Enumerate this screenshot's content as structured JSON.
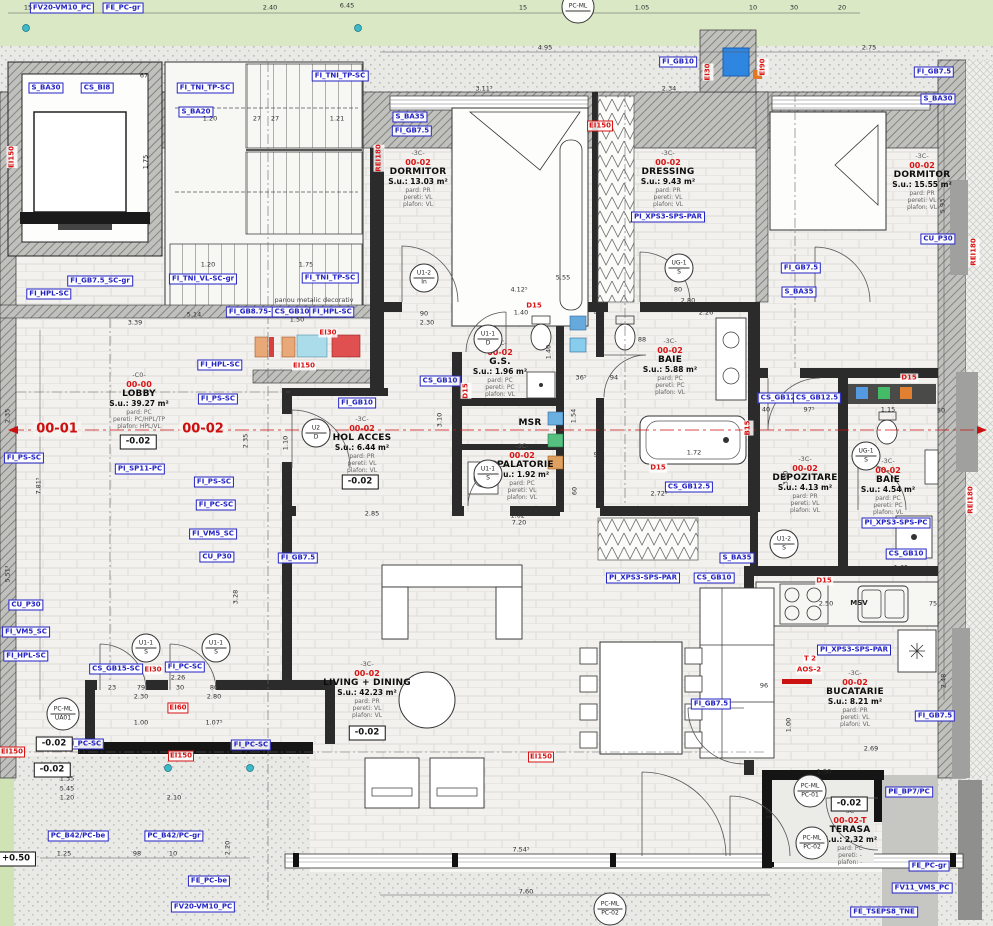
{
  "colors": {
    "label_blue": "#2323c4",
    "annotation_red": "#d81414",
    "wall_dark": "#2b2b2b",
    "hatch_gray": "#9a9a98",
    "floor": "#f1f0ed",
    "green_exterior": "#dbe8c6",
    "terrace_gray": "#c6c6c3",
    "fixture_blue": "#2e86e0"
  },
  "rooms": [
    {
      "grade": "-C0-",
      "code": "00-00",
      "name": "LOBBY",
      "area": "S.u.: 39.27 m²",
      "pard": "pard: PC",
      "pereti": "pereti: PC/HPL/TP",
      "plafon": "plafon: HPL/VL",
      "x": 139,
      "y": 372
    },
    {
      "grade": "-3C-",
      "code": "00-02",
      "name": "DORMITOR",
      "area": "S.u.: 13.03 m²",
      "pard": "pard: PR",
      "pereti": "pereti: VL",
      "plafon": "plafon: VL",
      "x": 418,
      "y": 150
    },
    {
      "grade": "-3C-",
      "code": "00-02",
      "name": "DRESSING",
      "area": "S.u.: 9.43 m²",
      "pard": "pard: PR",
      "pereti": "pereti: VL",
      "plafon": "plafon: VL",
      "x": 668,
      "y": 150
    },
    {
      "grade": "-3C-",
      "code": "00-02",
      "name": "DORMITOR",
      "area": "S.u.: 15.55 m²",
      "pard": "pard: PR",
      "pereti": "pereti: VL",
      "plafon": "plafon: VL",
      "x": 922,
      "y": 153
    },
    {
      "grade": "-3C-",
      "code": "00-02",
      "name": "G.S.",
      "area": "S.u.: 1.96 m²",
      "pard": "pard: PC",
      "pereti": "pereti: PC",
      "plafon": "plafon: VL",
      "x": 500,
      "y": 340
    },
    {
      "grade": "-3C-",
      "code": "00-02",
      "name": "BAIE",
      "area": "S.u.: 5.88 m²",
      "pard": "pard: PC",
      "pereti": "pereti: PC",
      "plafon": "plafon: VL",
      "x": 670,
      "y": 338
    },
    {
      "grade": "",
      "code": "",
      "name": "MSR",
      "area": "",
      "pard": "",
      "pereti": "",
      "plafon": "",
      "x": 530,
      "y": 418
    },
    {
      "grade": "-3C-",
      "code": "00-02",
      "name": "SPALATORIE",
      "area": "S.u.: 1.92 m²",
      "pard": "pard: PC",
      "pereti": "pereti: VL",
      "plafon": "plafon: VL",
      "x": 522,
      "y": 443
    },
    {
      "grade": "-3C-",
      "code": "00-02",
      "name": "HOL ACCES",
      "area": "S.u.: 6.44 m²",
      "pard": "pard: PR",
      "pereti": "pereti: VL",
      "plafon": "plafon: VL",
      "x": 362,
      "y": 416
    },
    {
      "grade": "-3C-",
      "code": "00-02",
      "name": "DEPOZITARE",
      "area": "S.u.: 4.13 m²",
      "pard": "pard: PR",
      "pereti": "pereti: VL",
      "plafon": "plafon: VL",
      "x": 805,
      "y": 456
    },
    {
      "grade": "-3C-",
      "code": "00-02",
      "name": "BAIE",
      "area": "S.u.: 4.54 m²",
      "pard": "pard: PC",
      "pereti": "pereti: PC",
      "plafon": "plafon: VL",
      "x": 888,
      "y": 458
    },
    {
      "grade": "-3C-",
      "code": "00-02",
      "name": "LIVING + DINING",
      "area": "S.u.: 42.23 m²",
      "pard": "pard: PR",
      "pereti": "pereti: VL",
      "plafon": "plafon: VL",
      "x": 367,
      "y": 661
    },
    {
      "grade": "-3C-",
      "code": "00-02",
      "name": "BUCATARIE",
      "area": "S.u.: 8.21 m²",
      "pard": "pard: PR",
      "pereti": "pereti: VL",
      "plafon": "plafon: VL",
      "x": 855,
      "y": 670
    },
    {
      "grade": "-3C-",
      "code": "00-02-T",
      "name": "TERASA",
      "area": "S.u.: 2.32 m²",
      "pard": "pard: PC",
      "pereti": "pereti: -",
      "plafon": "plafon: -",
      "x": 850,
      "y": 808
    }
  ],
  "axis_labels": [
    {
      "t": "00-01",
      "x": 57,
      "y": 429
    },
    {
      "t": "00-02",
      "x": 203,
      "y": 429
    }
  ],
  "blue_labels": [
    {
      "t": "FV20-VM10_PC",
      "x": 62,
      "y": 8
    },
    {
      "t": "FE_PC-gr",
      "x": 123,
      "y": 8
    },
    {
      "t": "S_BA30",
      "x": 46,
      "y": 88
    },
    {
      "t": "CS_BI8",
      "x": 97,
      "y": 88
    },
    {
      "t": "FI_TNI_TP-SC",
      "x": 205,
      "y": 88
    },
    {
      "t": "S_BA20",
      "x": 196,
      "y": 112
    },
    {
      "t": "FI_TNI_TP-SC",
      "x": 340,
      "y": 76
    },
    {
      "t": "FI_GB10",
      "x": 678,
      "y": 62
    },
    {
      "t": "FI_GB7.5",
      "x": 934,
      "y": 72
    },
    {
      "t": "S_BA30",
      "x": 938,
      "y": 99
    },
    {
      "t": "S_BA35",
      "x": 410,
      "y": 117
    },
    {
      "t": "FI_GB7.5",
      "x": 412,
      "y": 131
    },
    {
      "t": "PI_XPS3-SPS-PAR",
      "x": 668,
      "y": 217
    },
    {
      "t": "CU_P30",
      "x": 938,
      "y": 239
    },
    {
      "t": "FI_GB7.5_SC-gr",
      "x": 100,
      "y": 281
    },
    {
      "t": "FI_TNI_VL-SC-gr",
      "x": 203,
      "y": 279
    },
    {
      "t": "FI_TNI_TP-SC",
      "x": 330,
      "y": 278
    },
    {
      "t": "FI_HPL-SC",
      "x": 49,
      "y": 294
    },
    {
      "t": "FI_GB8.75-SC",
      "x": 255,
      "y": 312
    },
    {
      "t": "CS_GB10",
      "x": 292,
      "y": 312
    },
    {
      "t": "FI_HPL-SC",
      "x": 332,
      "y": 312
    },
    {
      "t": "FI_HPL-SC",
      "x": 220,
      "y": 365
    },
    {
      "t": "FI_GB7.5",
      "x": 801,
      "y": 268
    },
    {
      "t": "S_BA35",
      "x": 799,
      "y": 292
    },
    {
      "t": "FI_PS-SC",
      "x": 218,
      "y": 399
    },
    {
      "t": "FI_PS-SC",
      "x": 24,
      "y": 458
    },
    {
      "t": "PI_SP11-PC",
      "x": 140,
      "y": 469
    },
    {
      "t": "FI_PS-SC",
      "x": 214,
      "y": 482
    },
    {
      "t": "FI_PC-SC",
      "x": 216,
      "y": 505
    },
    {
      "t": "FI_VM5_SC",
      "x": 213,
      "y": 534
    },
    {
      "t": "CU_P30",
      "x": 217,
      "y": 557
    },
    {
      "t": "FI_GB7.5",
      "x": 298,
      "y": 558
    },
    {
      "t": "CS_GB10",
      "x": 440,
      "y": 381
    },
    {
      "t": "FI_GB10",
      "x": 357,
      "y": 403
    },
    {
      "t": "CS_GB12",
      "x": 778,
      "y": 398
    },
    {
      "t": "CS_GB12.5",
      "x": 817,
      "y": 398
    },
    {
      "t": "CS_GB12.5",
      "x": 689,
      "y": 487
    },
    {
      "t": "PI_XPS3-SPS-PAR",
      "x": 643,
      "y": 578
    },
    {
      "t": "CS_GB10",
      "x": 714,
      "y": 578
    },
    {
      "t": "S_BA35",
      "x": 737,
      "y": 558
    },
    {
      "t": "FI_GB7.5",
      "x": 711,
      "y": 704
    },
    {
      "t": "PI_XPS3-SPS-PAR",
      "x": 854,
      "y": 650
    },
    {
      "t": "FI_GB7.5",
      "x": 935,
      "y": 716
    },
    {
      "t": "PI_XPS3-SPS-PC",
      "x": 896,
      "y": 523
    },
    {
      "t": "CS_GB10",
      "x": 906,
      "y": 554
    },
    {
      "t": "CS_GB15-SC",
      "x": 116,
      "y": 669
    },
    {
      "t": "FI_PC-SC",
      "x": 185,
      "y": 667
    },
    {
      "t": "CU_P30",
      "x": 26,
      "y": 605
    },
    {
      "t": "FI_VM5_SC",
      "x": 26,
      "y": 632
    },
    {
      "t": "FI_HPL-SC",
      "x": 26,
      "y": 656
    },
    {
      "t": "FI_PC-SC",
      "x": 84,
      "y": 744
    },
    {
      "t": "FI_PC-SC",
      "x": 251,
      "y": 745
    },
    {
      "t": "PC_B42/PC-be",
      "x": 78,
      "y": 836
    },
    {
      "t": "PC_B42/PC-gr",
      "x": 174,
      "y": 836
    },
    {
      "t": "FE_PC-be",
      "x": 209,
      "y": 881
    },
    {
      "t": "FV20-VM10_PC",
      "x": 203,
      "y": 907
    },
    {
      "t": "PE_BP7/PC",
      "x": 909,
      "y": 792
    },
    {
      "t": "FE_PC-gr",
      "x": 929,
      "y": 866
    },
    {
      "t": "FV11_VMS_PC",
      "x": 922,
      "y": 888
    },
    {
      "t": "FE_TSEPS8_TNE",
      "x": 884,
      "y": 912
    }
  ],
  "red_labels": [
    {
      "t": "EI150",
      "x": 600,
      "y": 126,
      "b": 1
    },
    {
      "t": "EI90",
      "x": 763,
      "y": 67,
      "v": 1
    },
    {
      "t": "EI30",
      "x": 708,
      "y": 72,
      "v": 1
    },
    {
      "t": "REI180",
      "x": 974,
      "y": 252,
      "v": 1
    },
    {
      "t": "REI180",
      "x": 971,
      "y": 500,
      "v": 1
    },
    {
      "t": "REI180",
      "x": 379,
      "y": 158,
      "v": 1
    },
    {
      "t": "EI150",
      "x": 12,
      "y": 157,
      "v": 1
    },
    {
      "t": "EI150",
      "x": 12,
      "y": 752,
      "b": 1
    },
    {
      "t": "EI60",
      "x": 178,
      "y": 708,
      "b": 1
    },
    {
      "t": "EI150",
      "x": 181,
      "y": 756,
      "b": 1
    },
    {
      "t": "EI150",
      "x": 541,
      "y": 757,
      "b": 1
    },
    {
      "t": "EI30",
      "x": 153,
      "y": 670
    },
    {
      "t": "EI30",
      "x": 328,
      "y": 333
    },
    {
      "t": "EI150",
      "x": 304,
      "y": 366
    },
    {
      "t": "D15",
      "x": 534,
      "y": 306
    },
    {
      "t": "D15",
      "x": 909,
      "y": 378
    },
    {
      "t": "D15",
      "x": 824,
      "y": 581
    },
    {
      "t": "D15",
      "x": 658,
      "y": 468
    },
    {
      "t": "B15",
      "x": 748,
      "y": 428,
      "v": 1
    },
    {
      "t": "D15",
      "x": 466,
      "y": 391,
      "v": 1
    },
    {
      "t": "T 2",
      "x": 810,
      "y": 659
    },
    {
      "t": "AOS-2",
      "x": 809,
      "y": 670
    }
  ],
  "elevations": [
    {
      "t": "-0.02",
      "x": 138,
      "y": 442
    },
    {
      "t": "-0.02",
      "x": 360,
      "y": 482
    },
    {
      "t": "-0.02",
      "x": 367,
      "y": 733
    },
    {
      "t": "-0.02",
      "x": 54,
      "y": 744
    },
    {
      "t": "-0.02",
      "x": 52,
      "y": 770
    },
    {
      "t": "-0.02",
      "x": 849,
      "y": 804
    },
    {
      "t": "+0.50",
      "x": 16,
      "y": 859
    }
  ],
  "door_tags": [
    {
      "t": "U1-2",
      "b": "In",
      "x": 424,
      "y": 278
    },
    {
      "t": "U1-1",
      "b": "D",
      "x": 488,
      "y": 339
    },
    {
      "t": "U1-1",
      "b": "S",
      "x": 488,
      "y": 474
    },
    {
      "t": "UG-1",
      "b": "S",
      "x": 679,
      "y": 268
    },
    {
      "t": "U2",
      "b": "D",
      "x": 316,
      "y": 433
    },
    {
      "t": "U1-2",
      "b": "S",
      "x": 784,
      "y": 544
    },
    {
      "t": "UG-1",
      "b": "S",
      "x": 866,
      "y": 456
    },
    {
      "t": "U1-1",
      "b": "S",
      "x": 146,
      "y": 648
    },
    {
      "t": "U1-1",
      "b": "S",
      "x": 216,
      "y": 648
    },
    {
      "t": "PC-ML",
      "b": "UA01",
      "x": 63,
      "y": 714,
      "pc": 1
    },
    {
      "t": "PC-ML",
      "b": "PC-01",
      "x": 810,
      "y": 791,
      "pc": 1
    },
    {
      "t": "PC-ML",
      "b": "PC-02",
      "x": 812,
      "y": 843,
      "pc": 1
    },
    {
      "t": "PC-ML",
      "b": "PC-02",
      "x": 610,
      "y": 909,
      "pc": 1
    },
    {
      "t": "PC-ML",
      "b": "",
      "x": 578,
      "y": 7,
      "pc": 1
    }
  ],
  "dims": [
    {
      "t": "15",
      "x": 28,
      "y": 8
    },
    {
      "t": "2.40",
      "x": 270,
      "y": 8
    },
    {
      "t": "6.45",
      "x": 347,
      "y": 6
    },
    {
      "t": "15",
      "x": 523,
      "y": 8
    },
    {
      "t": "1.05",
      "x": 642,
      "y": 8
    },
    {
      "t": "10",
      "x": 753,
      "y": 8
    },
    {
      "t": "30",
      "x": 794,
      "y": 8
    },
    {
      "t": "20",
      "x": 842,
      "y": 8
    },
    {
      "t": "4.95",
      "x": 545,
      "y": 48
    },
    {
      "t": "2.75",
      "x": 869,
      "y": 48
    },
    {
      "t": "3.11⁵",
      "x": 484,
      "y": 89
    },
    {
      "t": "2.34",
      "x": 669,
      "y": 89
    },
    {
      "t": "67",
      "x": 144,
      "y": 76
    },
    {
      "t": "1.20",
      "x": 210,
      "y": 119
    },
    {
      "t": "27",
      "x": 257,
      "y": 119
    },
    {
      "t": "27",
      "x": 275,
      "y": 119
    },
    {
      "t": "1.21",
      "x": 337,
      "y": 119
    },
    {
      "t": "1.75",
      "x": 146,
      "y": 162,
      "v": 1
    },
    {
      "t": "5.14",
      "x": 194,
      "y": 315
    },
    {
      "t": "3.39",
      "x": 135,
      "y": 323
    },
    {
      "t": "1.20",
      "x": 208,
      "y": 265
    },
    {
      "t": "1.75",
      "x": 306,
      "y": 265
    },
    {
      "t": "1.50",
      "x": 297,
      "y": 320
    },
    {
      "t": "90",
      "x": 424,
      "y": 314
    },
    {
      "t": "2.30",
      "x": 427,
      "y": 323
    },
    {
      "t": "1.40",
      "x": 521,
      "y": 313
    },
    {
      "t": "44",
      "x": 598,
      "y": 313
    },
    {
      "t": "2.26",
      "x": 706,
      "y": 313
    },
    {
      "t": "5.55",
      "x": 563,
      "y": 278
    },
    {
      "t": "4.12⁵",
      "x": 519,
      "y": 290
    },
    {
      "t": "80",
      "x": 678,
      "y": 290
    },
    {
      "t": "2.80",
      "x": 688,
      "y": 301
    },
    {
      "t": "88",
      "x": 642,
      "y": 340
    },
    {
      "t": "36⁵",
      "x": 581,
      "y": 378
    },
    {
      "t": "94",
      "x": 614,
      "y": 378
    },
    {
      "t": "1.40",
      "x": 549,
      "y": 352,
      "v": 1
    },
    {
      "t": "1.54",
      "x": 574,
      "y": 416,
      "v": 1
    },
    {
      "t": "90⁵",
      "x": 599,
      "y": 455
    },
    {
      "t": "1.72",
      "x": 694,
      "y": 453
    },
    {
      "t": "1.62⁵",
      "x": 519,
      "y": 516
    },
    {
      "t": "60",
      "x": 575,
      "y": 491,
      "v": 1
    },
    {
      "t": "7.20",
      "x": 519,
      "y": 523
    },
    {
      "t": "2.72⁵",
      "x": 659,
      "y": 494
    },
    {
      "t": "3.10",
      "x": 440,
      "y": 420,
      "v": 1
    },
    {
      "t": "2.85",
      "x": 372,
      "y": 514
    },
    {
      "t": "1.10",
      "x": 286,
      "y": 443,
      "v": 1
    },
    {
      "t": "2.35",
      "x": 246,
      "y": 441,
      "v": 1
    },
    {
      "t": "7.81⁵",
      "x": 39,
      "y": 486,
      "v": 1
    },
    {
      "t": "2.35",
      "x": 8,
      "y": 416,
      "v": 1
    },
    {
      "t": "5.51³",
      "x": 8,
      "y": 574,
      "v": 1
    },
    {
      "t": "40",
      "x": 766,
      "y": 410
    },
    {
      "t": "97⁵",
      "x": 809,
      "y": 410
    },
    {
      "t": "1.15",
      "x": 888,
      "y": 410
    },
    {
      "t": "50",
      "x": 941,
      "y": 411
    },
    {
      "t": "2.64",
      "x": 844,
      "y": 489,
      "v": 1
    },
    {
      "t": "3.00",
      "x": 786,
      "y": 478,
      "v": 1
    },
    {
      "t": "1.65",
      "x": 901,
      "y": 568
    },
    {
      "t": "3.28",
      "x": 236,
      "y": 597,
      "v": 1
    },
    {
      "t": "2.26",
      "x": 178,
      "y": 678
    },
    {
      "t": "2.50",
      "x": 826,
      "y": 604
    },
    {
      "t": "75",
      "x": 933,
      "y": 604
    },
    {
      "t": "2.48",
      "x": 944,
      "y": 681,
      "v": 1
    },
    {
      "t": "96",
      "x": 764,
      "y": 686
    },
    {
      "t": "1.00",
      "x": 789,
      "y": 725,
      "v": 1
    },
    {
      "t": "2.69",
      "x": 871,
      "y": 749
    },
    {
      "t": "1.50",
      "x": 824,
      "y": 772
    },
    {
      "t": "1.0",
      "x": 769,
      "y": 814,
      "v": 1
    },
    {
      "t": "23",
      "x": 112,
      "y": 688
    },
    {
      "t": "79",
      "x": 141,
      "y": 688
    },
    {
      "t": "30",
      "x": 180,
      "y": 688
    },
    {
      "t": "80",
      "x": 214,
      "y": 688
    },
    {
      "t": "14⁵",
      "x": 247,
      "y": 688
    },
    {
      "t": "2.30",
      "x": 141,
      "y": 697
    },
    {
      "t": "2.80",
      "x": 214,
      "y": 697
    },
    {
      "t": "1.00",
      "x": 141,
      "y": 723
    },
    {
      "t": "1.07⁵",
      "x": 214,
      "y": 723
    },
    {
      "t": "1.35",
      "x": 67,
      "y": 779
    },
    {
      "t": "5.45",
      "x": 67,
      "y": 789
    },
    {
      "t": "1.20",
      "x": 67,
      "y": 798
    },
    {
      "t": "2.10",
      "x": 174,
      "y": 798
    },
    {
      "t": "1.25",
      "x": 64,
      "y": 854
    },
    {
      "t": "98",
      "x": 137,
      "y": 854
    },
    {
      "t": "10",
      "x": 173,
      "y": 854
    },
    {
      "t": "2.20",
      "x": 228,
      "y": 848,
      "v": 1
    },
    {
      "t": "7.54⁵",
      "x": 521,
      "y": 850
    },
    {
      "t": "7.60",
      "x": 526,
      "y": 892
    },
    {
      "t": "5.93",
      "x": 943,
      "y": 206,
      "v": 1
    }
  ],
  "notes": [
    {
      "t": "panou metalic decorativ",
      "x": 314,
      "y": 300
    },
    {
      "t": "MSV",
      "x": 859,
      "y": 603,
      "bold": 1
    }
  ]
}
